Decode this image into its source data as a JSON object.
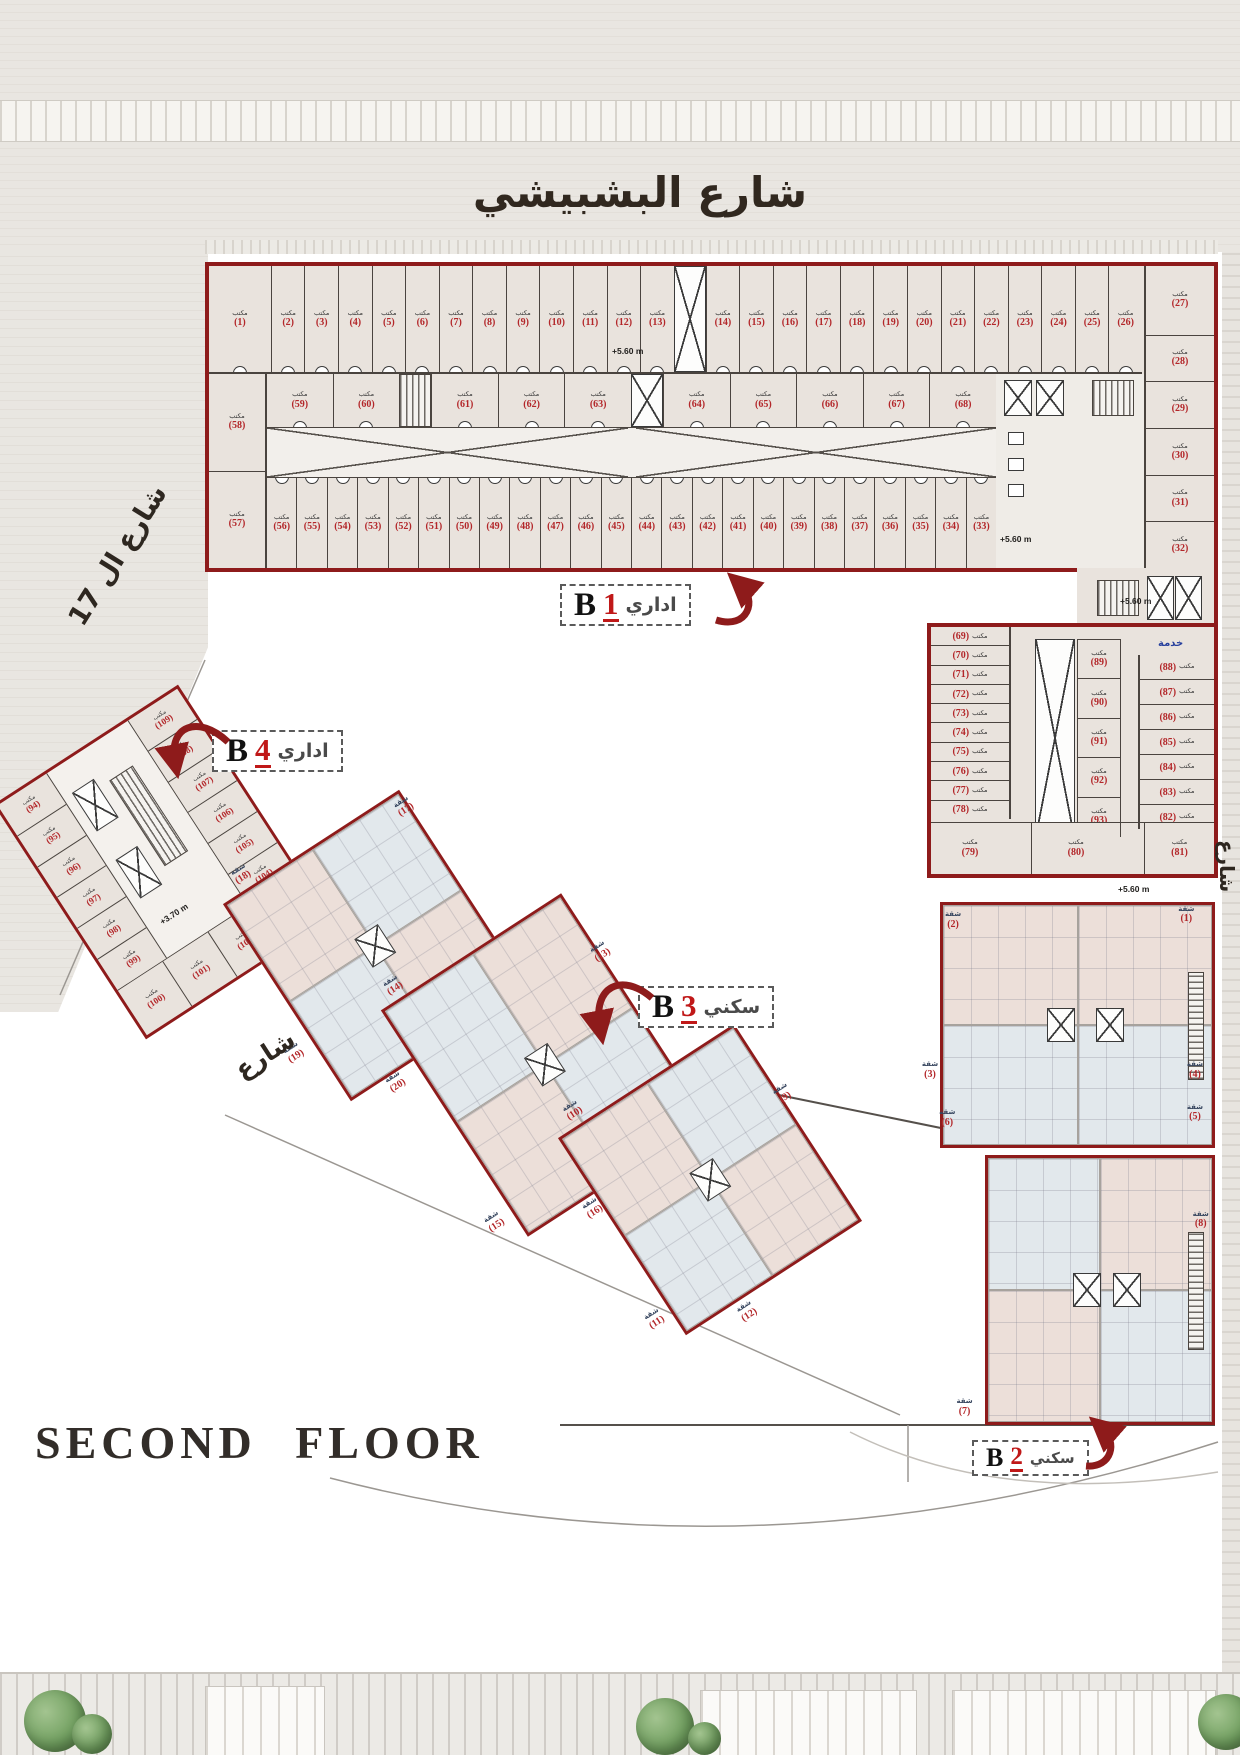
{
  "page": {
    "floor_title": "SECOND FLOOR"
  },
  "streets": {
    "top": "شارع البشبيشي",
    "left": "شارع ال 17",
    "right": "شارع",
    "b3_side": "شارع"
  },
  "labels": {
    "office": "مكتب",
    "apartment": "شقة",
    "service": "خدمة"
  },
  "annotations": {
    "lvl560": "+5.60 m",
    "lvl370": "+3.70 m"
  },
  "b1": {
    "letter": "B",
    "num": "1",
    "type": "اداري",
    "top_row": [
      "1",
      "2",
      "3",
      "4",
      "5",
      "6",
      "7",
      "8",
      "9",
      "10",
      "11",
      "12",
      "13",
      "14",
      "15",
      "16",
      "17",
      "18",
      "19",
      "20",
      "21",
      "22",
      "23",
      "24",
      "25",
      "26"
    ],
    "right_col": [
      "27",
      "28",
      "29",
      "30",
      "31",
      "32"
    ],
    "left_col": [
      "58",
      "57"
    ],
    "mid_row": [
      "59",
      "60",
      "61",
      "62",
      "63",
      "64",
      "65",
      "66",
      "67",
      "68"
    ],
    "bottom_row": [
      "56",
      "55",
      "54",
      "53",
      "52",
      "51",
      "50",
      "49",
      "48",
      "47",
      "46",
      "45",
      "44",
      "43",
      "42",
      "41",
      "40",
      "39",
      "38",
      "37",
      "36",
      "35",
      "34",
      "33"
    ],
    "wing_left": [
      "69",
      "70",
      "71",
      "72",
      "73",
      "74",
      "75",
      "76",
      "77",
      "78"
    ],
    "wing_mid": [
      "89",
      "90",
      "91",
      "92",
      "93"
    ],
    "wing_right": [
      "88",
      "87",
      "86",
      "85",
      "84",
      "83",
      "82"
    ],
    "wing_bottom": [
      "79",
      "80",
      "81"
    ]
  },
  "b4": {
    "letter": "B",
    "num": "4",
    "type": "اداري",
    "col_a": [
      "94",
      "95",
      "96",
      "97",
      "98",
      "99"
    ],
    "col_b": [
      "109",
      "108",
      "107",
      "106",
      "105",
      "104"
    ],
    "bottom": [
      "100",
      "101",
      "102",
      "103"
    ]
  },
  "b3": {
    "letter": "B",
    "num": "3",
    "type": "سكني",
    "block1_labels": [
      {
        "n": "18",
        "x": 14,
        "y": -12
      },
      {
        "n": "17",
        "x": 99,
        "y": 2
      },
      {
        "n": "19",
        "x": -12,
        "y": 66
      },
      {
        "n": "20",
        "x": 22,
        "y": 101
      }
    ],
    "block2_labels": [
      {
        "n": "14",
        "x": 10,
        "y": -10
      },
      {
        "n": "13",
        "x": 102,
        "y": 22
      },
      {
        "n": "15",
        "x": -11,
        "y": 86
      },
      {
        "n": "16",
        "x": 32,
        "y": 102
      }
    ],
    "block3_labels": [
      {
        "n": "10",
        "x": 12,
        "y": -12
      },
      {
        "n": "9",
        "x": 103,
        "y": 32
      },
      {
        "n": "11",
        "x": -10,
        "y": 84
      },
      {
        "n": "12",
        "x": 30,
        "y": 103
      }
    ]
  },
  "b2": {
    "letter": "B",
    "num": "2",
    "type": "سكني",
    "labels": [
      {
        "n": "2",
        "x": 8,
        "y": 3
      },
      {
        "n": "1",
        "x": 89,
        "y": 2
      },
      {
        "n": "3",
        "x": 0,
        "y": 31
      },
      {
        "n": "4",
        "x": 92,
        "y": 31
      },
      {
        "n": "6",
        "x": 6,
        "y": 40
      },
      {
        "n": "5",
        "x": 92,
        "y": 39
      },
      {
        "n": "7",
        "x": 12,
        "y": 94
      },
      {
        "n": "8",
        "x": 94,
        "y": 59
      }
    ]
  }
}
